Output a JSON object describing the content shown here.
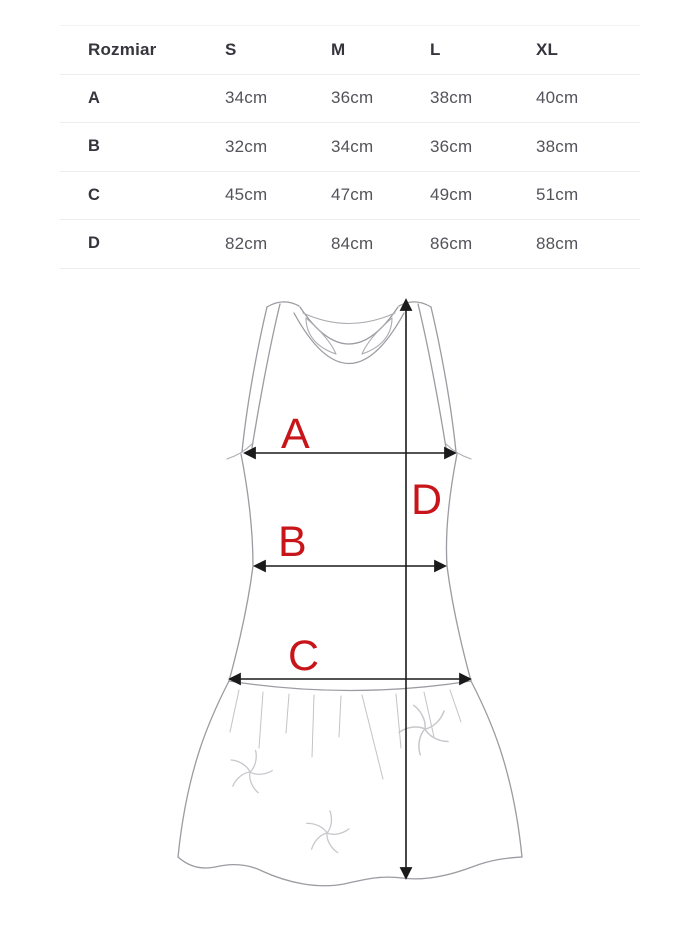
{
  "size_chart": {
    "header": [
      "Rozmiar",
      "S",
      "M",
      "L",
      "XL"
    ],
    "rows": [
      {
        "label": "A",
        "values": [
          "34cm",
          "36cm",
          "38cm",
          "40cm"
        ]
      },
      {
        "label": "B",
        "values": [
          "32cm",
          "34cm",
          "36cm",
          "38cm"
        ]
      },
      {
        "label": "C",
        "values": [
          "45cm",
          "47cm",
          "49cm",
          "51cm"
        ]
      },
      {
        "label": "D",
        "values": [
          "82cm",
          "84cm",
          "86cm",
          "88cm"
        ]
      }
    ]
  },
  "diagram": {
    "measure_labels": {
      "a": "A",
      "b": "B",
      "c": "C",
      "d": "D"
    },
    "label_color": "#c8151a",
    "line_color": "#1a1a1a",
    "outline_color": "#9b9ba1"
  }
}
